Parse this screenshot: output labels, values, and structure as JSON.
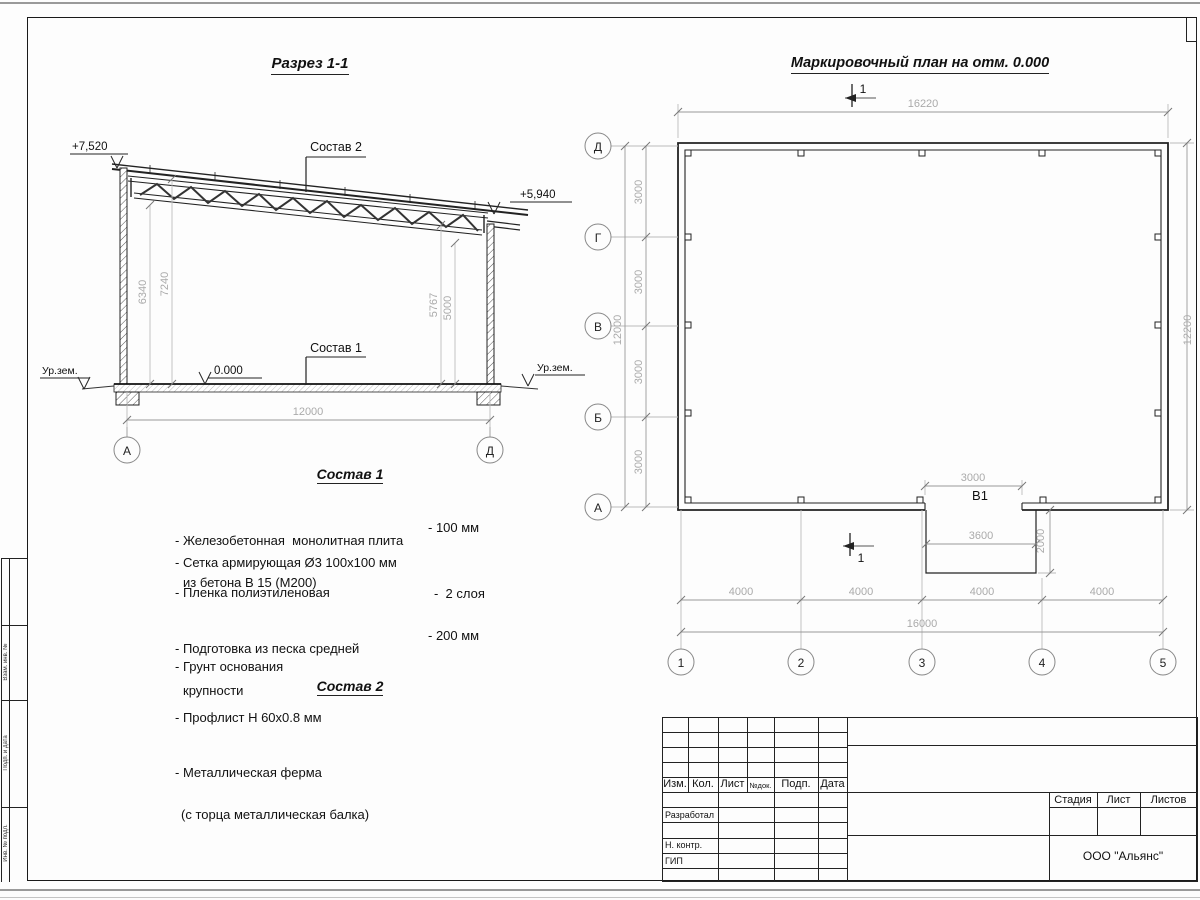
{
  "drawing": {
    "section": {
      "title": "Разрез 1-1",
      "label_sostav1": "Состав 1",
      "label_sostav2": "Состав 2",
      "elev_top_left": "+7,520",
      "elev_top_right": "+5,940",
      "elev_zero": "0.000",
      "ground_left": "Ур.зем.",
      "ground_right": "Ур.зем.",
      "dim_h_left1": "6340",
      "dim_h_left2": "7240",
      "dim_h_right1": "5767",
      "dim_h_right2": "5000",
      "dim_span": "12000",
      "axis_left": "А",
      "axis_right": "Д"
    },
    "plan": {
      "title": "Маркировочный план на отм. 0.000",
      "section_mark": "1",
      "dim_top": "16220",
      "dim_right": "12200",
      "dim_left_total": "12000",
      "dim_bottom_total": "16000",
      "row_dims": [
        "3000",
        "3000",
        "3000",
        "3000"
      ],
      "col_dims": [
        "4000",
        "4000",
        "4000",
        "4000"
      ],
      "row_axes": [
        "Д",
        "Г",
        "В",
        "Б",
        "А"
      ],
      "col_axes": [
        "1",
        "2",
        "3",
        "4",
        "5"
      ],
      "opening_label": "В1",
      "opening_dim": "3000",
      "apron_width": "3600",
      "apron_depth": "2000"
    },
    "sostav1": {
      "title": "Состав 1",
      "items": [
        {
          "line1": "- Железобетонная  монолитная плита",
          "line2": "из бетона В 15 (М200)",
          "value": "- 100 мм"
        },
        {
          "line1": "- Сетка армирующая Ø3 100х100 мм",
          "line2": "",
          "value": ""
        },
        {
          "line1": "- Пленка полиэтиленовая",
          "line2": "",
          "value": "-  2 слоя"
        },
        {
          "line1": "- Подготовка из песка средней",
          "line2": "крупности",
          "value": "- 200 мм"
        },
        {
          "line1": "- Грунт основания",
          "line2": "",
          "value": ""
        }
      ]
    },
    "sostav2": {
      "title": "Состав 2",
      "items": [
        {
          "line1": "- Профлист Н 60х0.8 мм",
          "line2": ""
        },
        {
          "line1": "- Металлическая ферма",
          "line2": "(с торца металлическая балка)"
        }
      ]
    },
    "titleblock": {
      "rev_headers": [
        "Изм.",
        "Кол.",
        "Лист",
        "№док.",
        "Подп.",
        "Дата"
      ],
      "roles": [
        "Разработал",
        "Н. контр.",
        "ГИП"
      ],
      "stage_headers": [
        "Стадия",
        "Лист",
        "Листов"
      ],
      "company": "ООО \"Альянс\""
    },
    "margin": {
      "labels": [
        "Взам. инв. №",
        "Подп. и дата",
        "Инв. № подл."
      ]
    }
  }
}
